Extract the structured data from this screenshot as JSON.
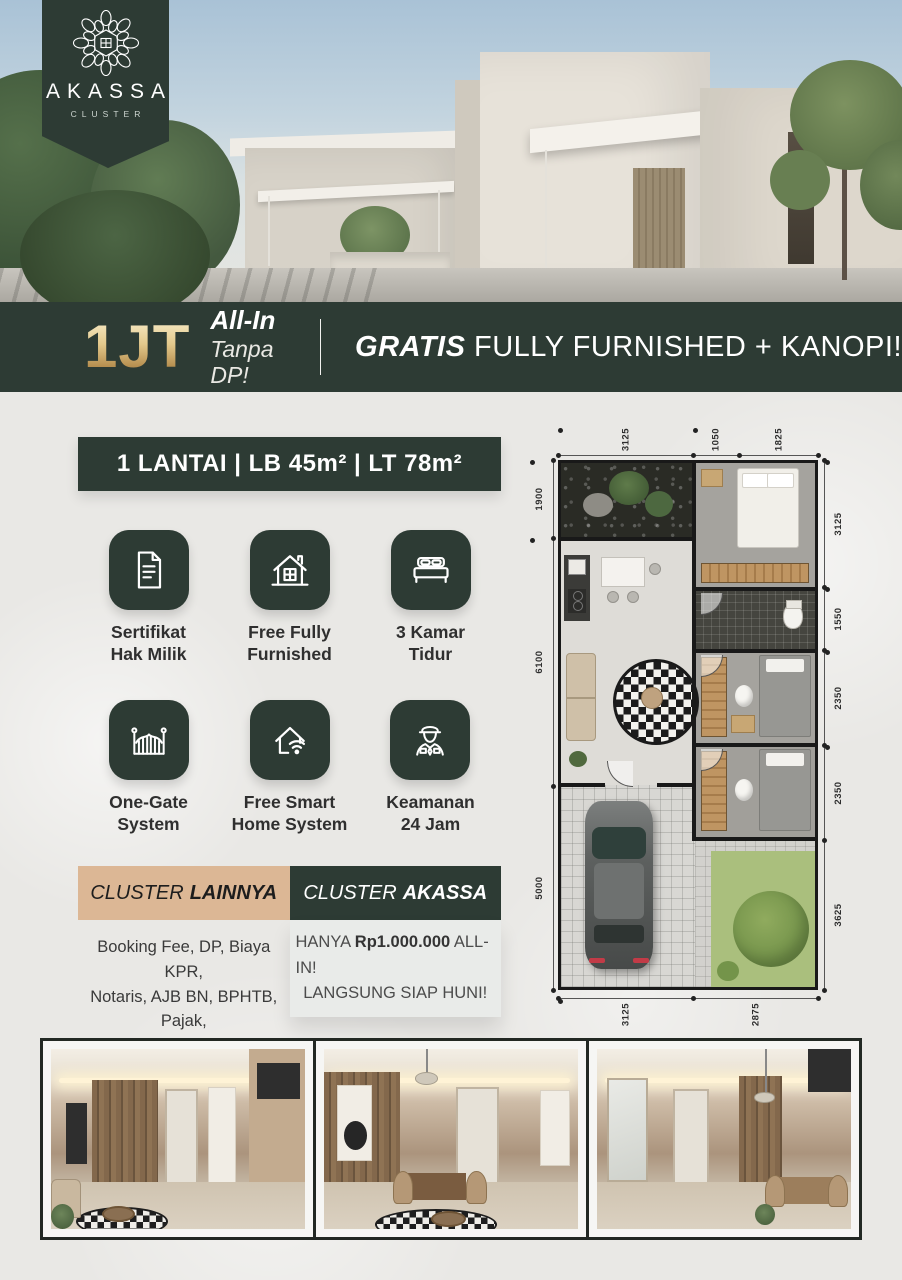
{
  "logo": {
    "icon": "mandala-house-icon",
    "brand": "AKASSA",
    "subtitle": "CLUSTER"
  },
  "promo": {
    "price": "1JT",
    "allin": "All-In",
    "tanpa_dp": "Tanpa DP!",
    "gratis": "GRATIS",
    "gratis_rest": " FULLY FURNISHED + KANOPI!"
  },
  "spec_header": "1 LANTAI | LB 45m² | LT 78m²",
  "features": [
    {
      "icon": "document-certificate-icon",
      "label": "Sertifikat\nHak Milik"
    },
    {
      "icon": "furnished-house-icon",
      "label": "Free Fully\nFurnished"
    },
    {
      "icon": "bed-icon",
      "label": "3 Kamar\nTidur"
    },
    {
      "icon": "gate-icon",
      "label": "One-Gate\nSystem"
    },
    {
      "icon": "smart-home-wifi-icon",
      "label": "Free Smart\nHome System"
    },
    {
      "icon": "security-guard-icon",
      "label": "Keamanan\n24 Jam"
    }
  ],
  "comparison": {
    "others": {
      "title_prefix": "CLUSTER",
      "title_bold": "LAINNYA",
      "body": "Booking Fee, DP, Biaya KPR,\nNotaris, AJB BN, BPHTB, Pajak,\nFurniture ±Rp110.000.000"
    },
    "akassa": {
      "title_prefix": "CLUSTER",
      "title_bold": "AKASSA",
      "line1_pre": "HANYA ",
      "line1_bold": "Rp1.000.000",
      "line1_post": " ALL-IN!",
      "line2": "LANGSUNG SIAP HUNI!"
    }
  },
  "floorplan": {
    "dims": {
      "top": [
        "3125",
        "1050",
        "1825"
      ],
      "right": [
        "3125",
        "1550",
        "2350",
        "2350",
        "3625"
      ],
      "left": [
        "1900",
        "6100",
        "5000"
      ],
      "bottom": [
        "3125",
        "2875"
      ]
    }
  },
  "colors": {
    "primary_green": "#2d3b34",
    "gold": "#c9a35f",
    "tan": "#dcb795",
    "page_background": "#e9e8e5"
  }
}
